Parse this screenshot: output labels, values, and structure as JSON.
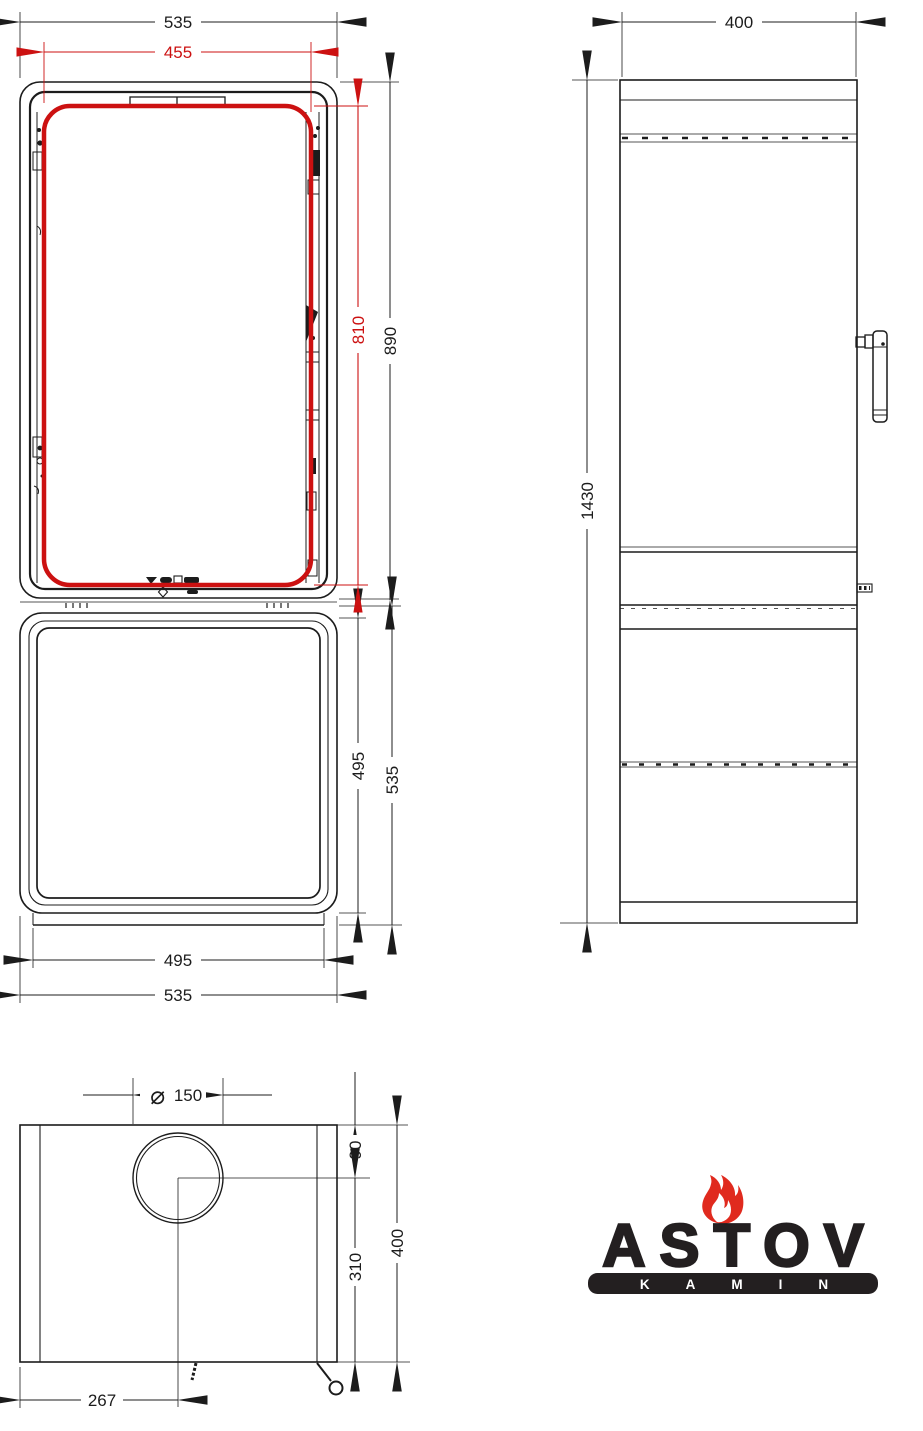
{
  "front_view": {
    "overall_width": "535",
    "glass_width": "455",
    "glass_height": "810",
    "upper_section_height": "890",
    "base_inner_height": "495",
    "base_overall_height": "535",
    "base_inner_width": "495",
    "base_overall_width": "535"
  },
  "side_view": {
    "depth": "400",
    "overall_height": "1430"
  },
  "plan_view": {
    "flue_diameter_symbol": "⌀",
    "flue_diameter": "150",
    "flue_center_from_rear": "90",
    "flue_center_to_front": "310",
    "overall_depth": "400",
    "flue_center_from_left": "267"
  },
  "logo": {
    "brand": "ASTOV",
    "tagline": "KAMIN"
  },
  "colors": {
    "line": "#1c1c1c",
    "highlight": "#cc1111",
    "logo_ink": "#231f20",
    "flame": "#e02a1e"
  }
}
